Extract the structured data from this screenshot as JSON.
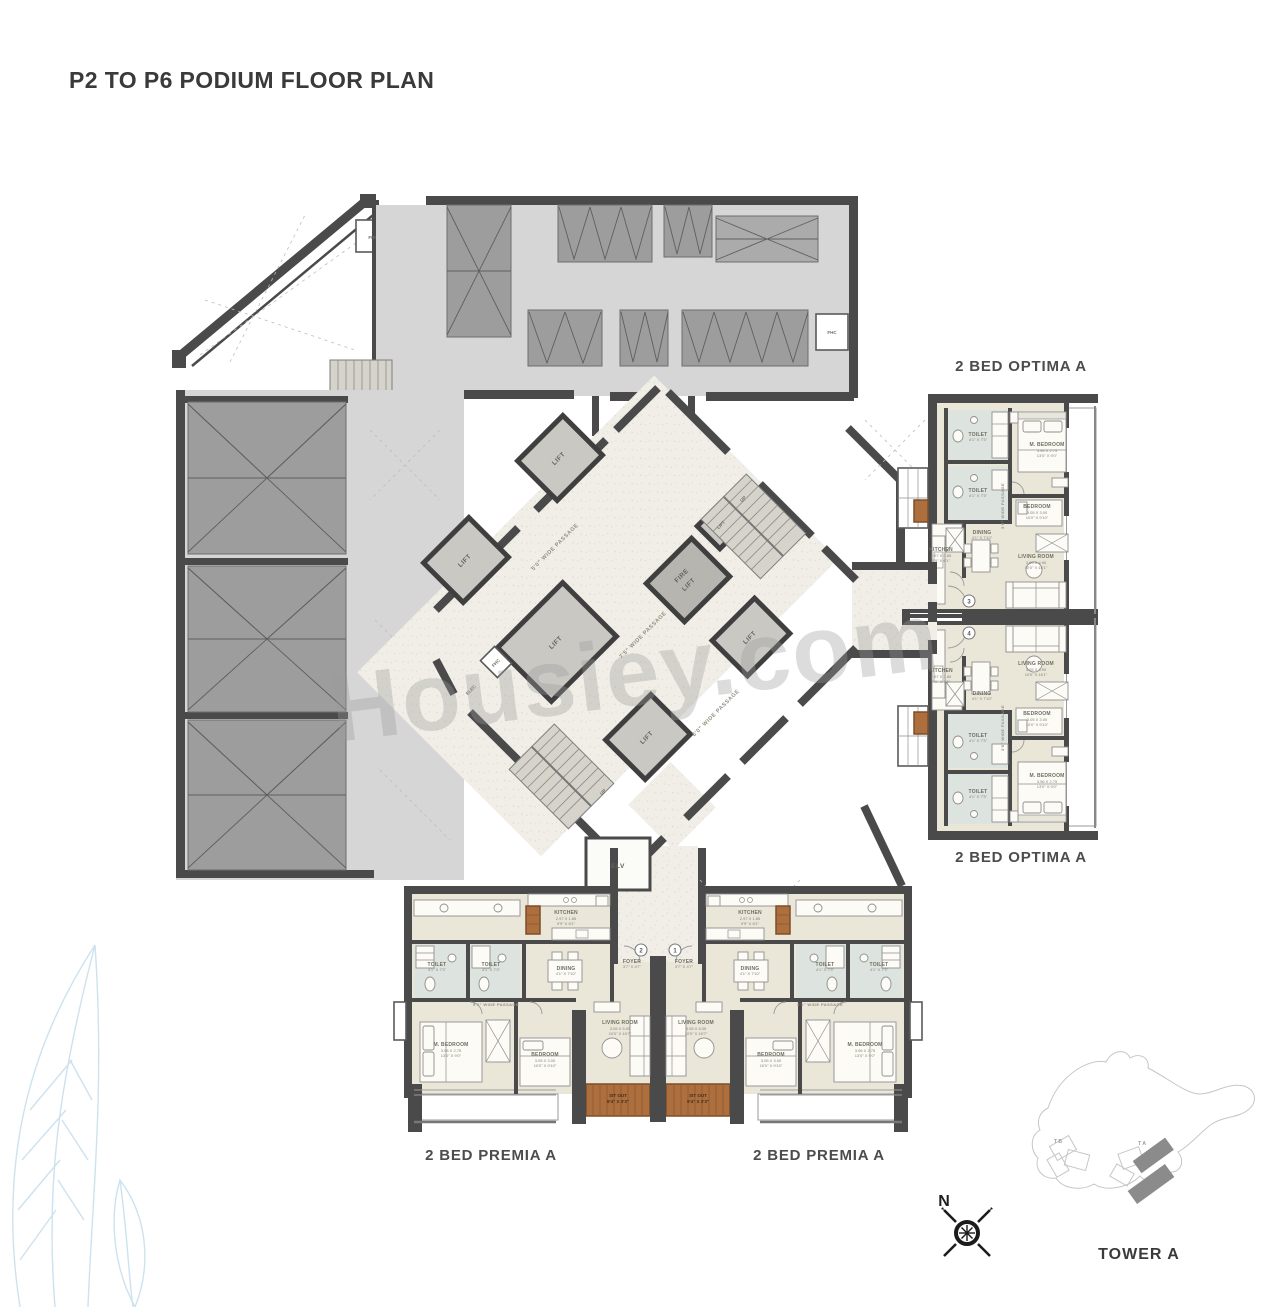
{
  "title": "P2 TO P6 PODIUM FLOOR PLAN",
  "watermark": "Housiey.com",
  "compass": {
    "north": "N"
  },
  "sitemap": {
    "tower": "TOWER A",
    "tower_a_key": "T A",
    "tower_b_key": "T B"
  },
  "units": {
    "optima_top": {
      "label": "2 BED OPTIMA A",
      "entry_no": "3"
    },
    "optima_bottom": {
      "label": "2 BED OPTIMA A",
      "entry_no": "4"
    },
    "premia_left": {
      "label": "2 BED PREMIA A",
      "entry_no": "2"
    },
    "premia_right": {
      "label": "2 BED PREMIA A",
      "entry_no": "1"
    }
  },
  "core": {
    "lift": "LIFT",
    "fire_lift_1": "FIRE",
    "fire_lift_2": "LIFT",
    "elv": "ELV",
    "fhc": "FHC",
    "elec": "ELEC",
    "up": "UP"
  },
  "passages": {
    "p50": "5'0\" WIDE PASSAGE",
    "p75": "7'5\" WIDE PASSAGE",
    "p60": "6'0\" WIDE PASSAGE",
    "p51": "5'1\" WIDE PASSAGE",
    "p36": "3'6\" WIDE PASSAGE"
  },
  "rooms": {
    "m_bedroom": {
      "name": "M. BEDROOM",
      "m": "3.96 X 2.75",
      "ft": "13'0\" X 9'0\""
    },
    "bedroom": {
      "name": "BEDROOM",
      "m": "3.05 X 3.00",
      "ft": "10'0\" X 9'10\""
    },
    "living_optima": {
      "name": "LIVING ROOM",
      "m": "3.05 X 4.90",
      "ft": "10'0\" X 16'1\""
    },
    "living_premia": {
      "name": "LIVING ROOM",
      "m": "3.05 X 5.05",
      "ft": "10'0\" X 16'7\""
    },
    "kitchen": {
      "name": "KITCHEN",
      "m": "2.97 X 1.85",
      "ft": "9'9\" X 6'1\""
    },
    "dining": {
      "name": "DINING",
      "ft": "4'1\" X 7'10\""
    },
    "toilet": {
      "name": "TOILET",
      "ft": "4'1\" X 7'3\""
    },
    "foyer": {
      "name": "FOYER",
      "ft": "3'7\" X 4'7\""
    },
    "sit_out": {
      "name": "SIT OUT",
      "ft": "9'4\" X 3'3\""
    }
  },
  "colors": {
    "wall": "#4a4a4a",
    "parking_floor": "#d6d6d6",
    "apartment_floor": "#eae7d9",
    "deck_wood": "#ad6f3e",
    "leaf_accent": "#cde2ef"
  }
}
